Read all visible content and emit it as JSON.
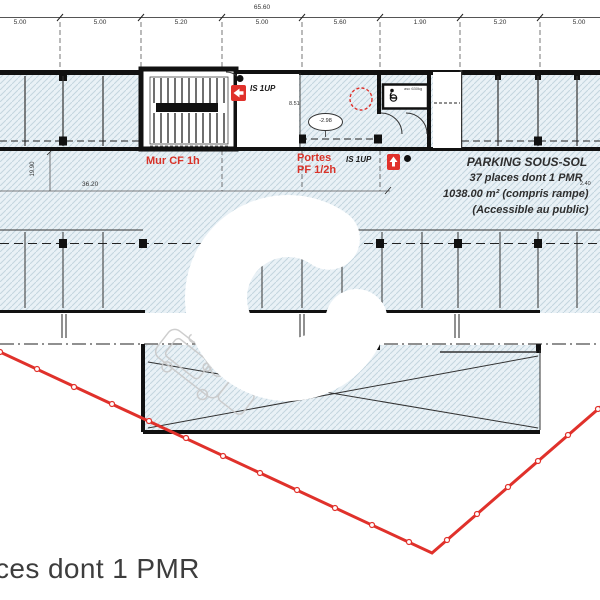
{
  "title": "Parking basement floor plan",
  "dimensions": {
    "overall_width": "65.60",
    "top": [
      "5.00",
      "5.00",
      "5.20",
      "5.00",
      "5.60",
      "1.90",
      "5.20",
      "5.00"
    ],
    "left_vertical": "19.90",
    "interior_width": "36.20",
    "interior_small": "8.51",
    "right_small": "2.40",
    "level_marker": "-2.98"
  },
  "labels": {
    "fire_wall": "Mur CF 1h",
    "fire_doors": "Portes\nPF 1/2h",
    "exit_1": "IS 1UP",
    "exit_2": "IS 1UP",
    "elevator": "asc 630kg"
  },
  "parking_info": {
    "title": "PARKING SOUS-SOL",
    "line2": "37 places dont 1 PMR",
    "line3": "1038.00 m² (compris rampe)",
    "line4": "(Accessible au public)"
  },
  "caption": "ces dont 1 PMR",
  "icons": {
    "exit_icon": "red square with white arrow (issue de secours)",
    "wheelchair_icon": "accessible elevator pictogram",
    "column_marker": "black square structural column",
    "level_oval": "ellipse level tag",
    "boundary_marker": "small circle on red property line"
  },
  "colors": {
    "accent_red": "#e0312b",
    "label_red": "#d83228",
    "hatch_bg": "#e9f1f6",
    "hatch_line": "#c3d5df",
    "wall": "#111111",
    "text_dark": "#3a3a3a"
  }
}
